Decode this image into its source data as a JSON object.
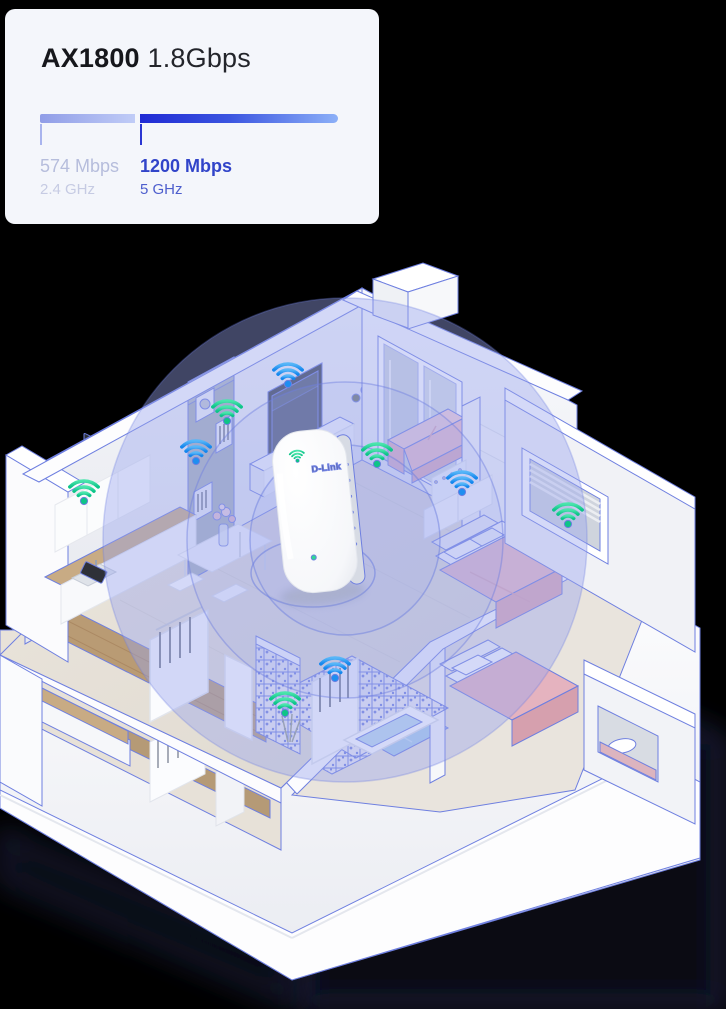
{
  "page": {
    "background_color": "#000000"
  },
  "spec_card": {
    "background_color": "#f4f6fb",
    "model": "AX1800",
    "total_speed": "1.8Gbps",
    "bar": {
      "total_width_px": 298,
      "gap_px": 5
    },
    "bands": [
      {
        "id": "2g",
        "speed_label": "574 Mbps",
        "band_label": "2.4 GHz",
        "mbps": 574,
        "gradient_start": "#909de7",
        "gradient_end": "#c0ccf7",
        "tick_color": "#a9b4ee"
      },
      {
        "id": "5g",
        "speed_label": "1200 Mbps",
        "band_label": "5 GHz",
        "mbps": 1200,
        "gradient_start": "#1f2ad4",
        "gradient_end": "#8cb0f8",
        "tick_color": "#2b36d2"
      }
    ]
  },
  "illustration": {
    "device": {
      "brand": "D-Link",
      "kind": "mesh-wifi-extender"
    },
    "coverage": {
      "fill_color": "#98a5ee",
      "ring_color": "#6e7fe0"
    },
    "wifi_icons": [
      {
        "color": "blue",
        "x": 288,
        "y": 378
      },
      {
        "color": "green",
        "x": 227,
        "y": 415
      },
      {
        "color": "blue",
        "x": 196,
        "y": 455
      },
      {
        "color": "green",
        "x": 84,
        "y": 495
      },
      {
        "color": "green",
        "x": 377,
        "y": 458
      },
      {
        "color": "blue",
        "x": 462,
        "y": 486
      },
      {
        "color": "green",
        "x": 568,
        "y": 518
      },
      {
        "color": "blue",
        "x": 335,
        "y": 672
      },
      {
        "color": "green",
        "x": 285,
        "y": 707
      }
    ],
    "icon_colors": {
      "green": {
        "start": "#4ae5ac",
        "end": "#0cc489",
        "dot": "#0ec487"
      },
      "blue": {
        "start": "#57b6f8",
        "end": "#1486ee",
        "dot": "#1f8ef0"
      }
    }
  }
}
